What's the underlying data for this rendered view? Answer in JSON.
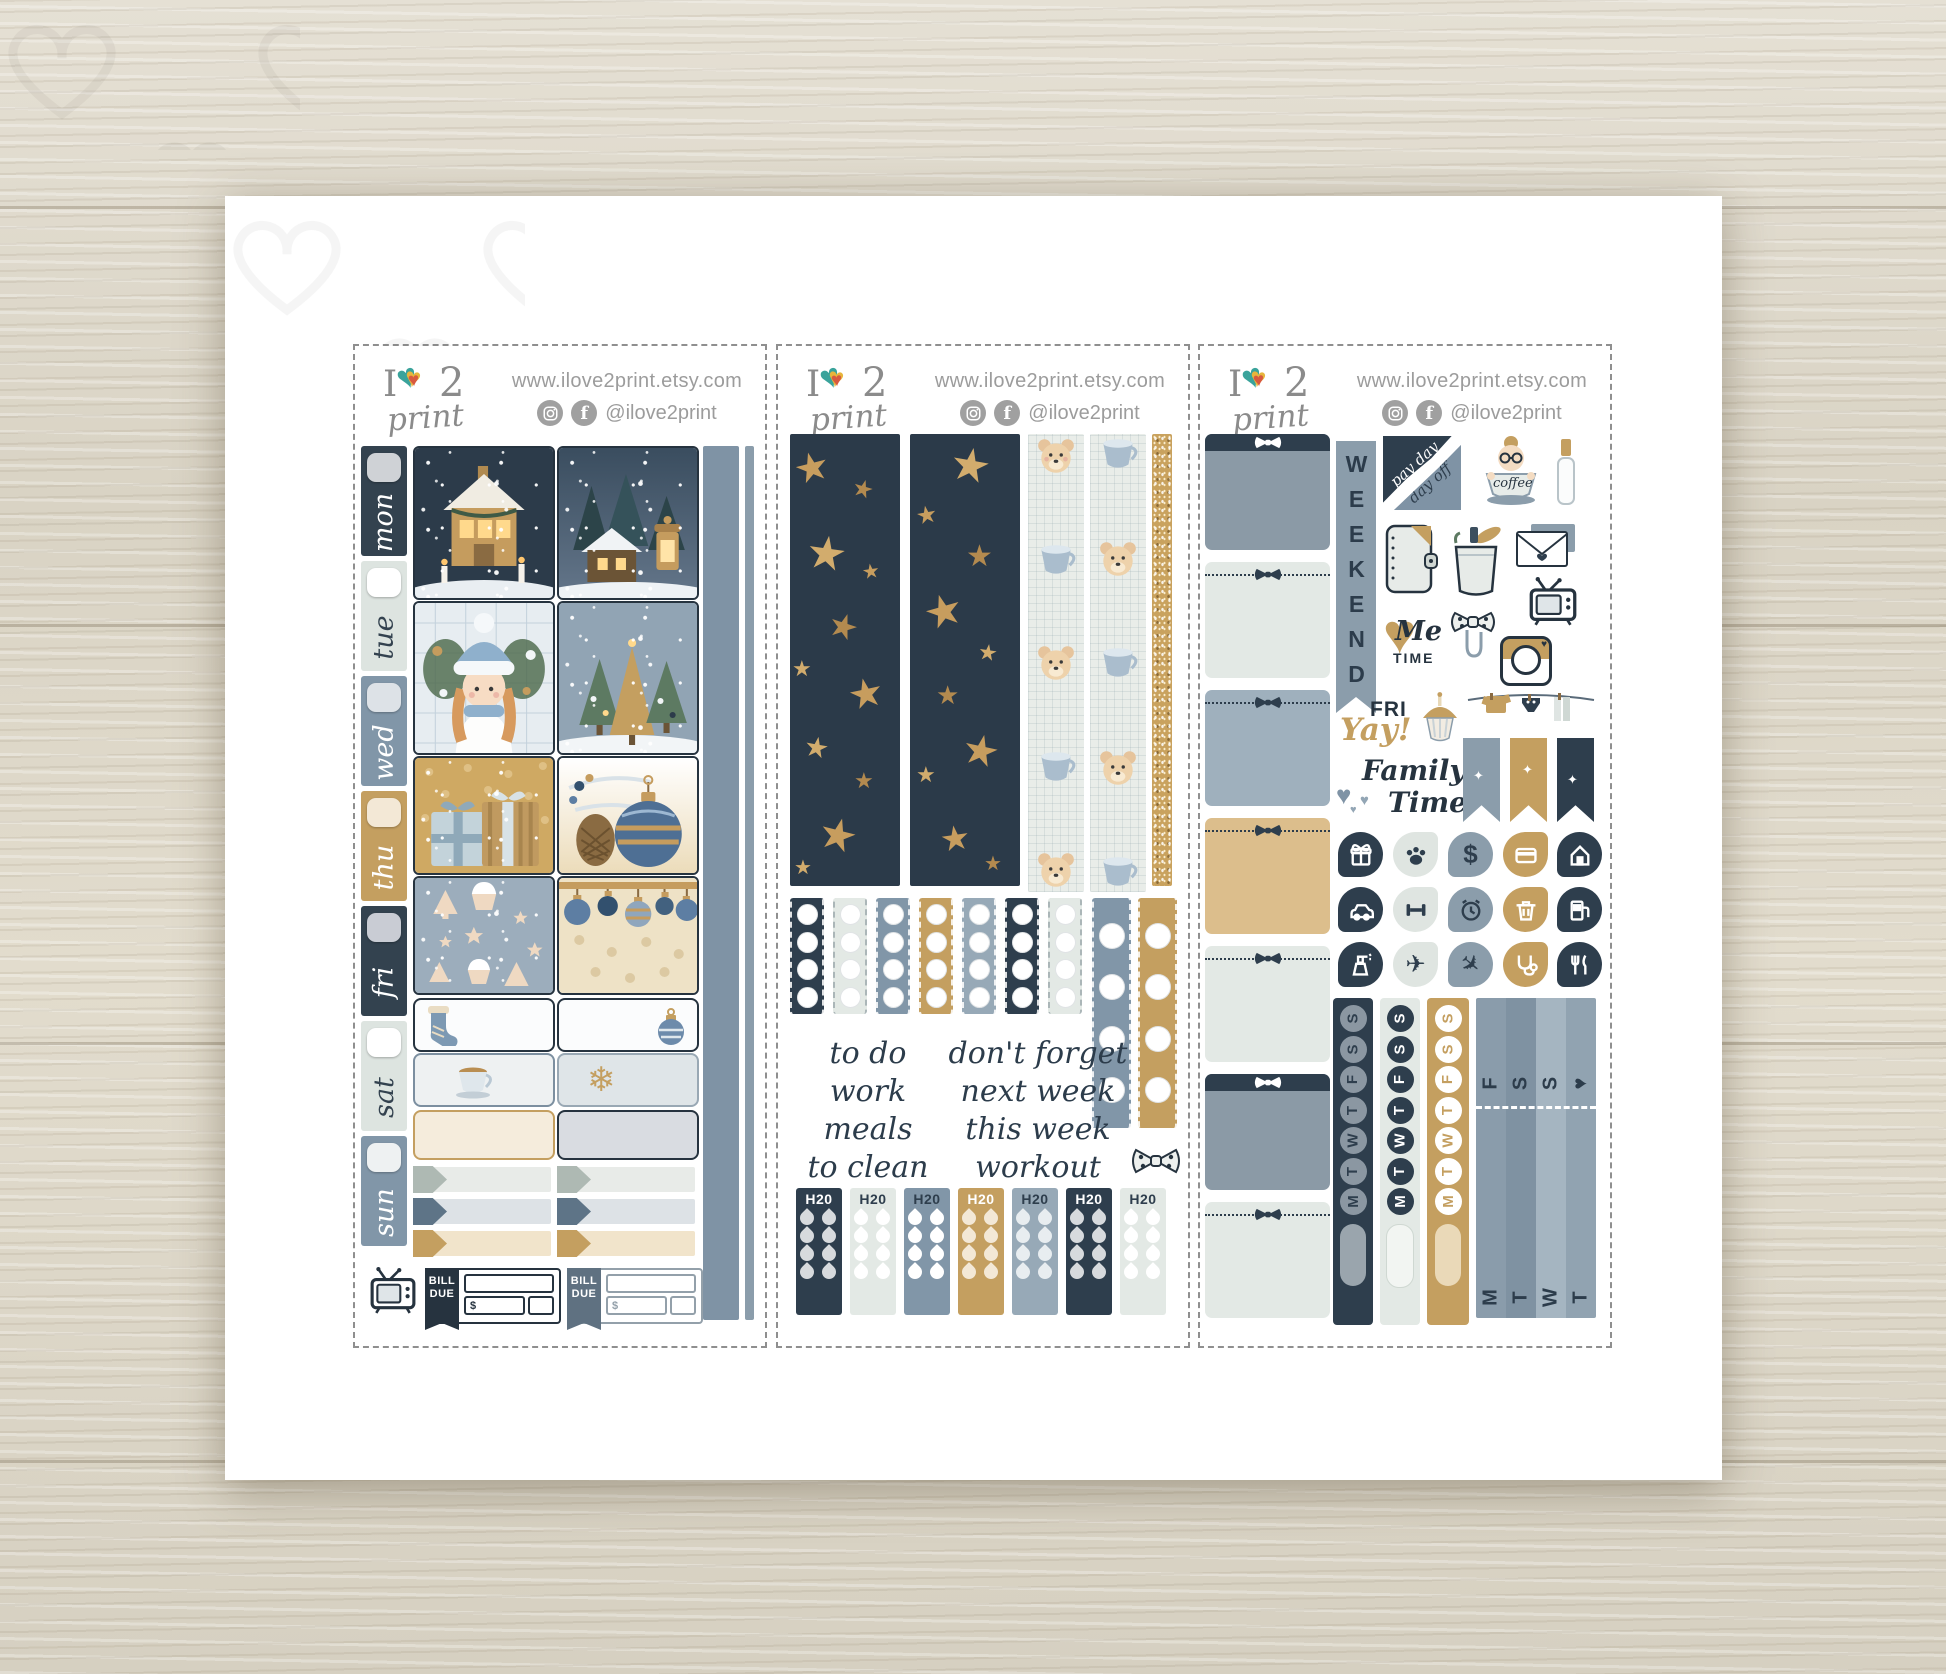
{
  "glyphs": {
    "heart": "♥",
    "star": "★",
    "snowflake": "❄",
    "sparkle": "✦",
    "plane": "✈"
  },
  "brand": {
    "logo_i": "I",
    "logo_2": "2",
    "logo_print": "print",
    "url": "www.ilove2print.etsy.com",
    "handle": "@ilove2print",
    "facebook_f": "f"
  },
  "sheet1": {
    "days": [
      "mon",
      "tue",
      "wed",
      "thu",
      "fri",
      "sat",
      "sun"
    ],
    "bill": {
      "l1": "BILL",
      "l2": "DUE",
      "cur": "$"
    }
  },
  "sheet2": {
    "col1": [
      "to do",
      "work",
      "meals",
      "to clean"
    ],
    "col2": [
      "don't forget",
      "next week",
      "this week",
      "workout"
    ],
    "h2o": "H20"
  },
  "sheet3": {
    "weekend": "WEEKEND",
    "payday": "pay day",
    "dayoff": "day off",
    "coffee": "coffee",
    "me": "Me",
    "time_caps": "TIME",
    "fri": "FRI",
    "yay": "Yay!",
    "family": "Family",
    "time": "Time",
    "dollar": "$",
    "week": [
      "M",
      "T",
      "W",
      "T",
      "F",
      "S",
      "S"
    ],
    "washi_top": [
      "F",
      "S",
      "S",
      "♥"
    ],
    "washi_bottom": [
      "M",
      "T",
      "W",
      "T"
    ]
  }
}
